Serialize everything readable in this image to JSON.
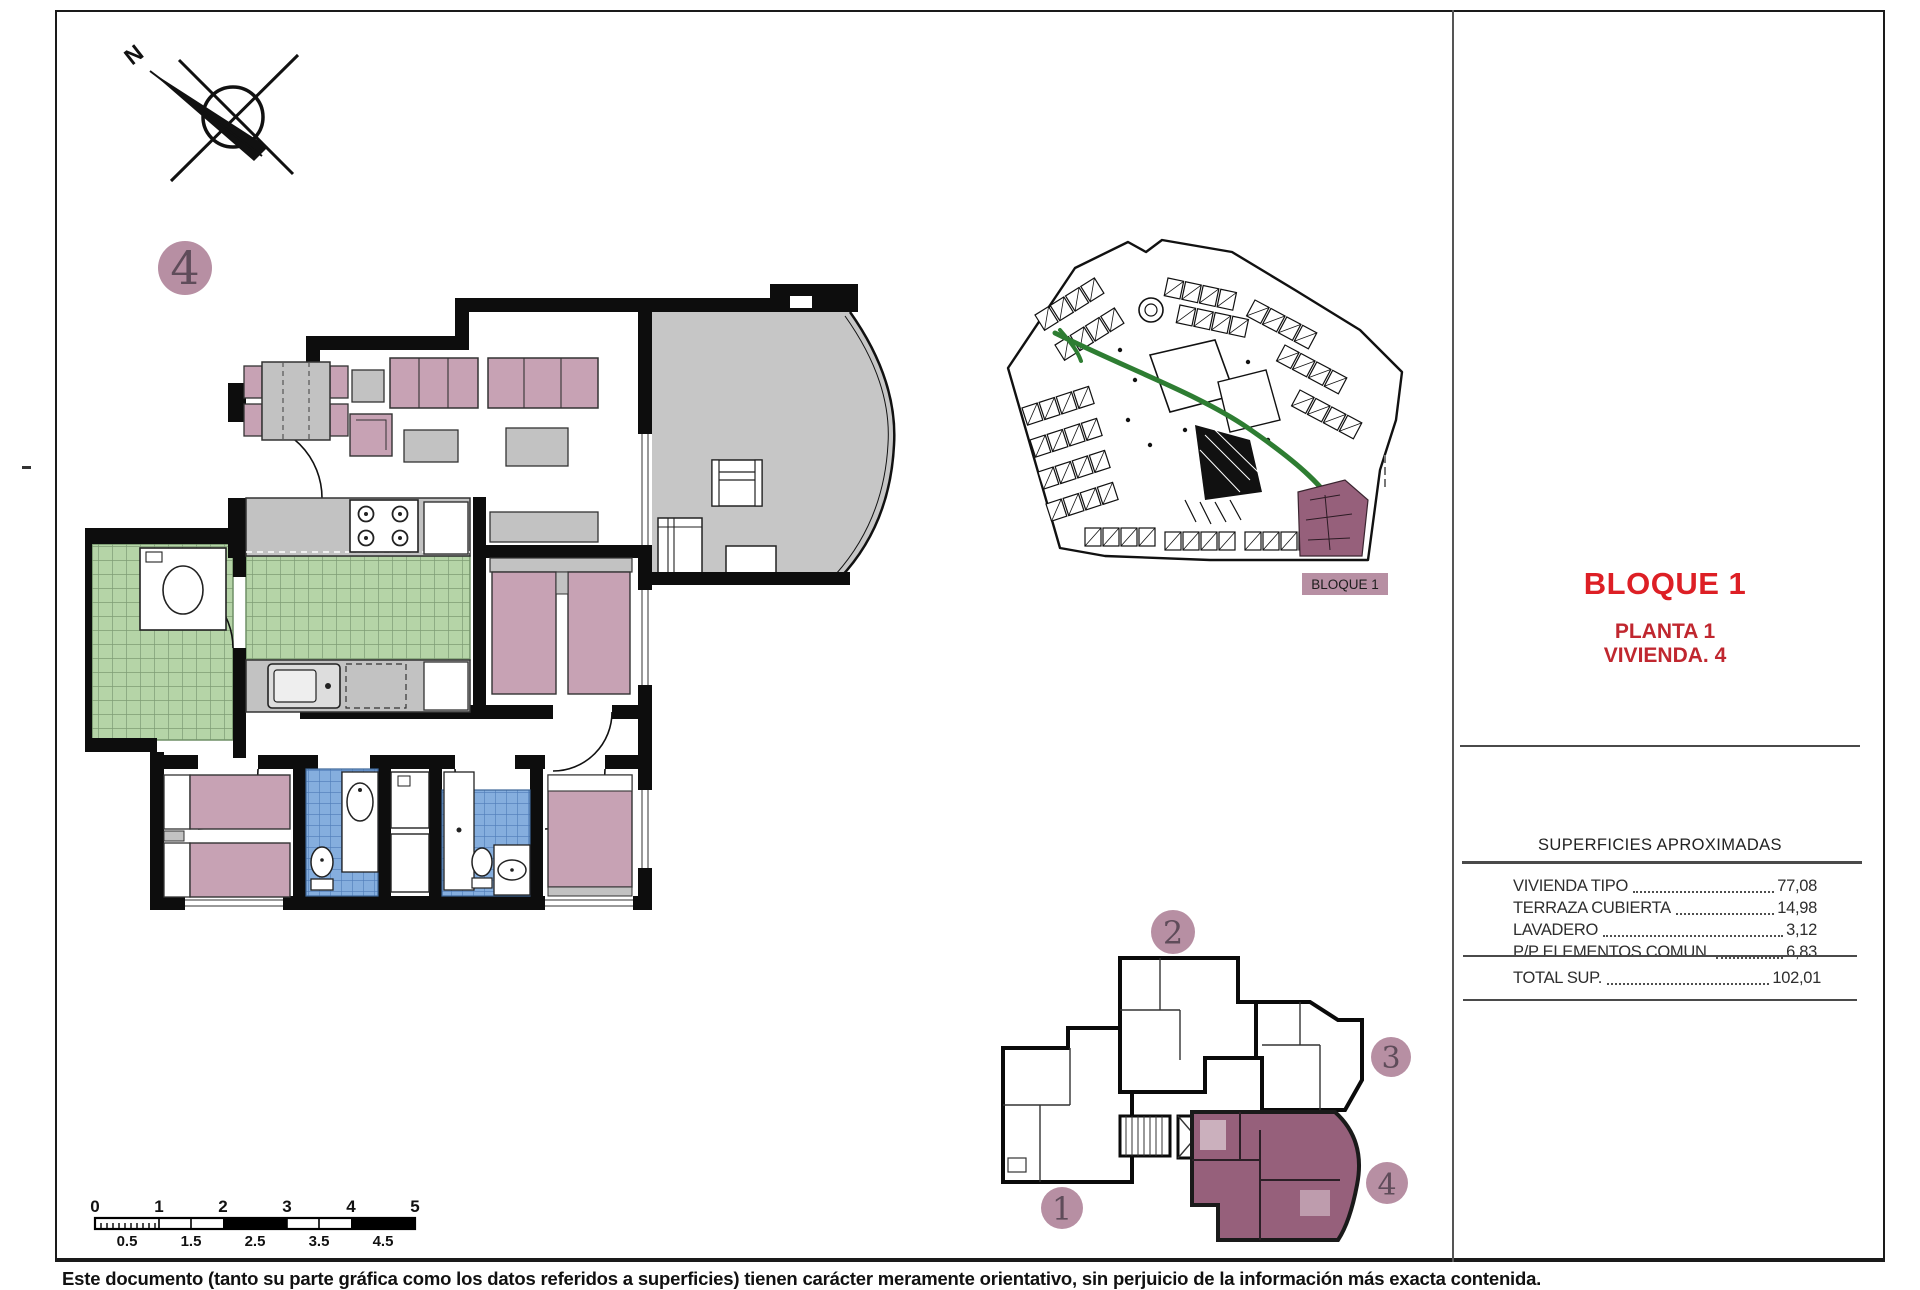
{
  "titles": {
    "block": "BLOQUE 1",
    "plant": "PLANTA 1",
    "unit": "VIVIENDA. 4"
  },
  "site_plan": {
    "label": "BLOQUE 1"
  },
  "compass": {
    "north_label": "N"
  },
  "badges": {
    "main": "4",
    "block_plan": [
      "1",
      "2",
      "3",
      "4"
    ]
  },
  "areas_table": {
    "header": "SUPERFICIES APROXIMADAS",
    "rows": [
      {
        "label": "VIVIENDA TIPO",
        "value": "77,08"
      },
      {
        "label": "TERRAZA CUBIERTA",
        "value": "14,98"
      },
      {
        "label": "LAVADERO",
        "value": "3,12"
      },
      {
        "label": "P/P ELEMENTOS COMUN.",
        "value": "6,83"
      }
    ],
    "total": {
      "label": "TOTAL SUP.",
      "value": "102,01"
    }
  },
  "scale_bar": {
    "top_labels": [
      "0",
      "1",
      "2",
      "3",
      "4",
      "5"
    ],
    "bottom_labels": [
      "0.5",
      "1.5",
      "2.5",
      "3.5",
      "4.5"
    ]
  },
  "disclaimer": {
    "text": "Este documento (tanto su parte gráfica como los datos referidos a superficies) tienen carácter meramente orientativo, sin perjuicio de la información más exacta contenida."
  },
  "colors": {
    "accent_red": "#dd1f25",
    "subtitle_red": "#c0272f",
    "badge_fill": "#b78fa3",
    "apartment_highlight": "#96607b",
    "terrace_gray": "#c6c6c6",
    "tile_green": "#b5d4a7",
    "tile_blue": "#85aede",
    "furniture_pink": "#c7a2b4",
    "furniture_gray": "#c2c2c2",
    "wall_black": "#0d0d0d",
    "road_green": "#2e7d32"
  }
}
